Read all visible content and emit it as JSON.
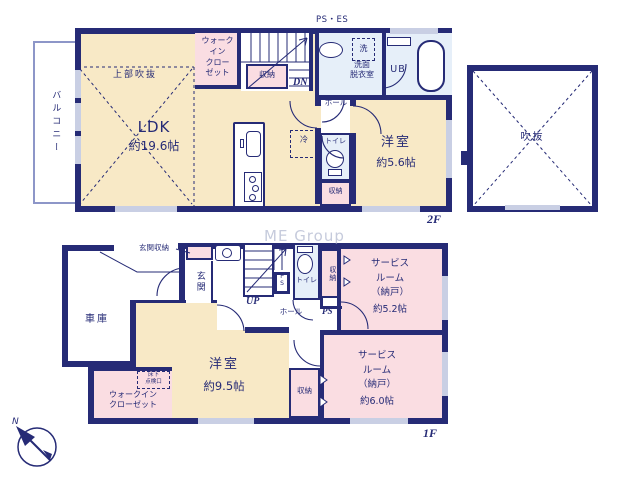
{
  "watermark": "ME Group",
  "f2": {
    "floor_label": "2F",
    "ps_es": "PS・ES",
    "balcony": "バルコニー",
    "upper_void": "上部吹抜",
    "ldk_name": "LDK",
    "ldk_size": "約19.6帖",
    "walk_in_closet": "ウォーク\nイン\nクロー\nゼット",
    "stair_storage": "収納",
    "down": "DN",
    "laundry": "洗",
    "washroom": "洗面\n脱衣室",
    "unit_bath": "UB",
    "hall": "ホール",
    "fridge": "冷",
    "toilet": "トイレ",
    "storage": "収納",
    "bedroom_name": "洋室",
    "bedroom_size": "約5.6帖",
    "void_label": "吹抜"
  },
  "f1": {
    "floor_label": "1F",
    "garage": "車庫",
    "entrance_storage": "玄関収納",
    "entrance": "玄関",
    "up": "UP",
    "pipe_space_box": "P\nS",
    "toilet": "トイレ",
    "closet_strip": "収納",
    "service_room1_name": "サービス\nルーム\n（納戸）",
    "service_room1_size": "約5.2帖",
    "hall": "ホール",
    "pipe_space": "PS",
    "bedroom_name": "洋室",
    "bedroom_size": "約9.5帖",
    "floor_hatch": "床下\n点検口",
    "walk_in_closet": "ウォークイン\nクローゼット",
    "mid_storage": "収納",
    "service_room2_name": "サービス\nルーム\n（納戸）",
    "service_room2_size": "約6.0帖",
    "north": "N"
  },
  "colors": {
    "wall": "#262b76",
    "room_cream": "#f8e9c6",
    "room_pink": "#fadde2",
    "room_blue": "#e6eff9"
  }
}
